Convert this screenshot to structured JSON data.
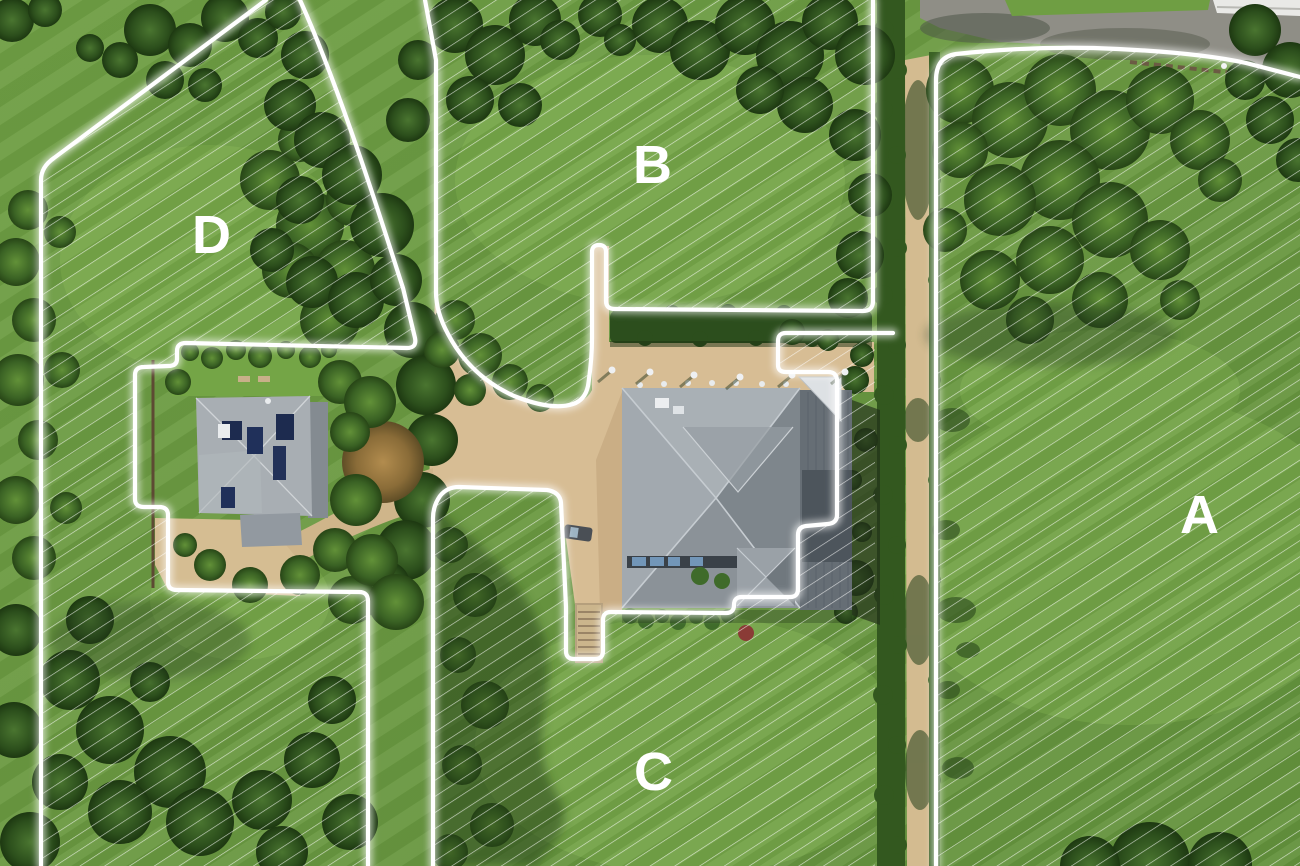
{
  "plots": {
    "a": {
      "label": "A"
    },
    "b": {
      "label": "B"
    },
    "c": {
      "label": "C"
    },
    "d": {
      "label": "D"
    }
  },
  "style": {
    "boundary_color": "#ffffff",
    "hatch_color": "#ffffff",
    "label_color": "#ffffff",
    "lawn_color": "#6f9e43",
    "tree_color": "#2f5222",
    "hedge_color": "#2c4e1d",
    "driveway_color": "#d7bd94",
    "roof_color": "#8f979d",
    "road_color": "#8f8e86"
  }
}
